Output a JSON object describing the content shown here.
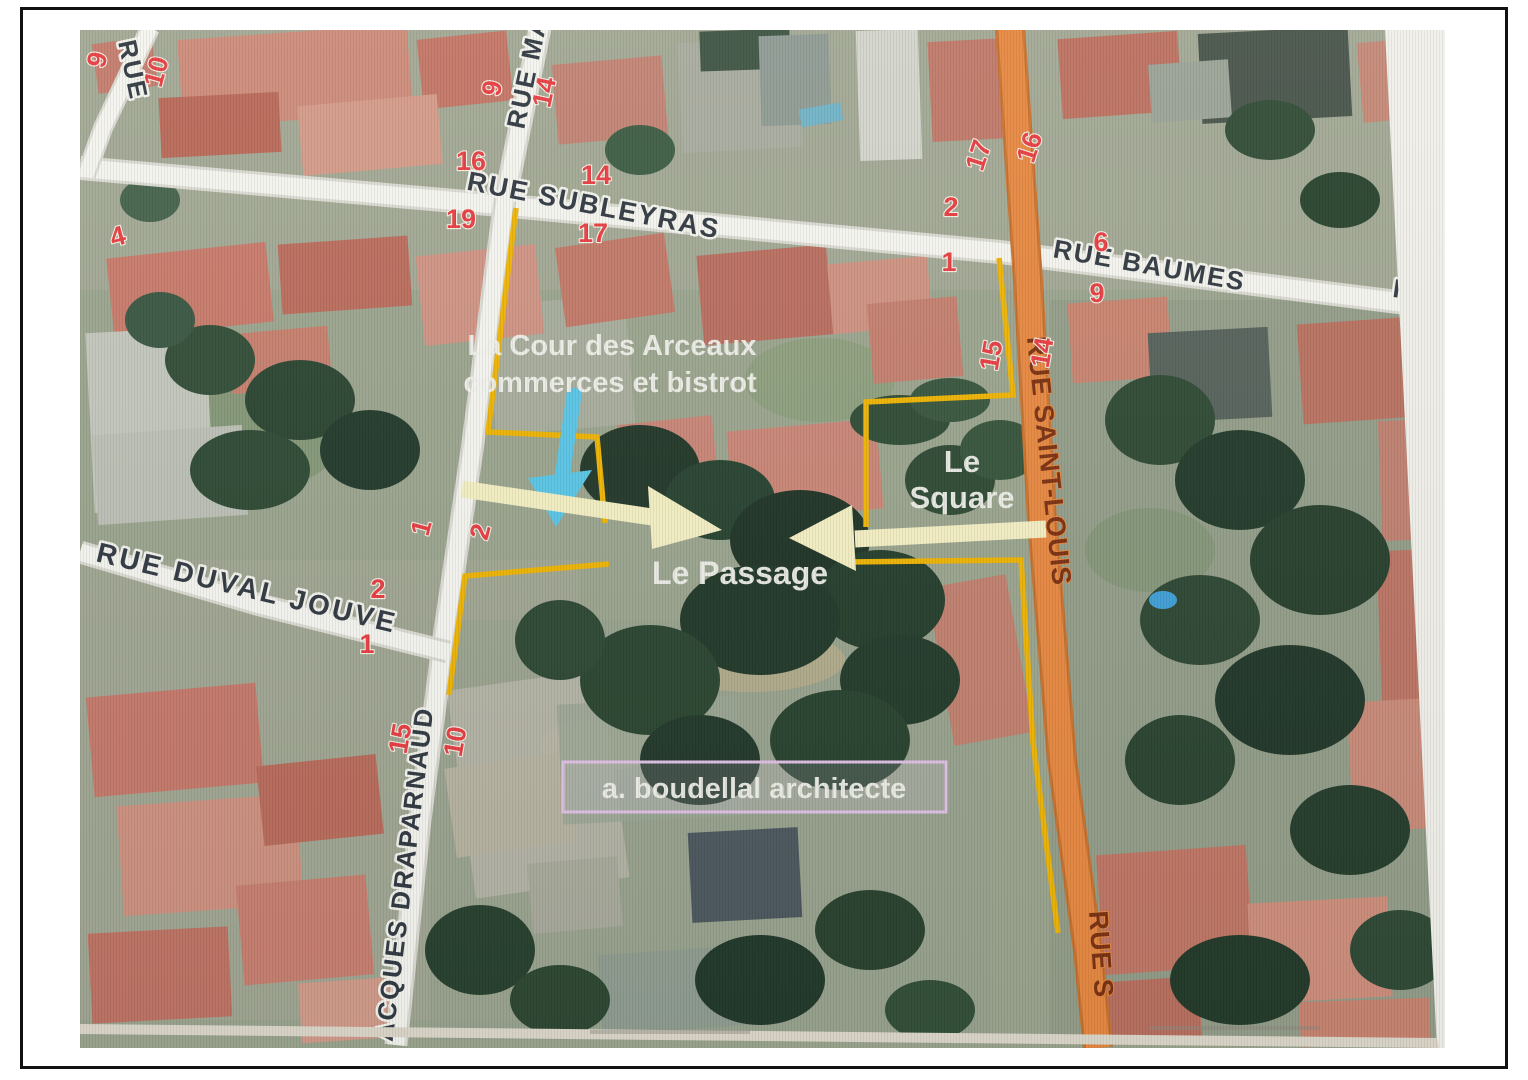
{
  "streets": {
    "rue_top_left": "RUE",
    "rue_ma": "RUE MA",
    "subleyras": "RUE SUBLEYRAS",
    "baumes": "RUE BAUMES",
    "rue_right": "RUE",
    "saint_louis": "RUE SAINT-LOUIS",
    "saint_louis_lower": "RUE S",
    "duval_jouve": "RUE DUVAL JOUVE",
    "draparnaud": "ACQUES DRAPARNAUD"
  },
  "annotations": {
    "cour_line1": "La Cour des Arceaux",
    "cour_line2": "commerces et bistrot",
    "square_line1": "Le",
    "square_line2": "Square",
    "passage": "Le Passage",
    "architect": "a. boudellal architecte"
  },
  "house_numbers": [
    "9",
    "10",
    "16",
    "19",
    "4",
    "14",
    "17",
    "9",
    "14",
    "17",
    "16",
    "2",
    "1",
    "6",
    "9",
    "15",
    "14",
    "1",
    "2",
    "2",
    "1",
    "15",
    "10"
  ],
  "colors": {
    "route_highlight": "#e2833c",
    "boundary_yellow": "#f0b400",
    "arrow_cyan": "#58c6e8",
    "arrow_pale_yellow": "#f5f0c4",
    "number_red": "#e93a40",
    "architect_box_border": "#e3c2ea",
    "road_white": "#f6f6f2"
  }
}
